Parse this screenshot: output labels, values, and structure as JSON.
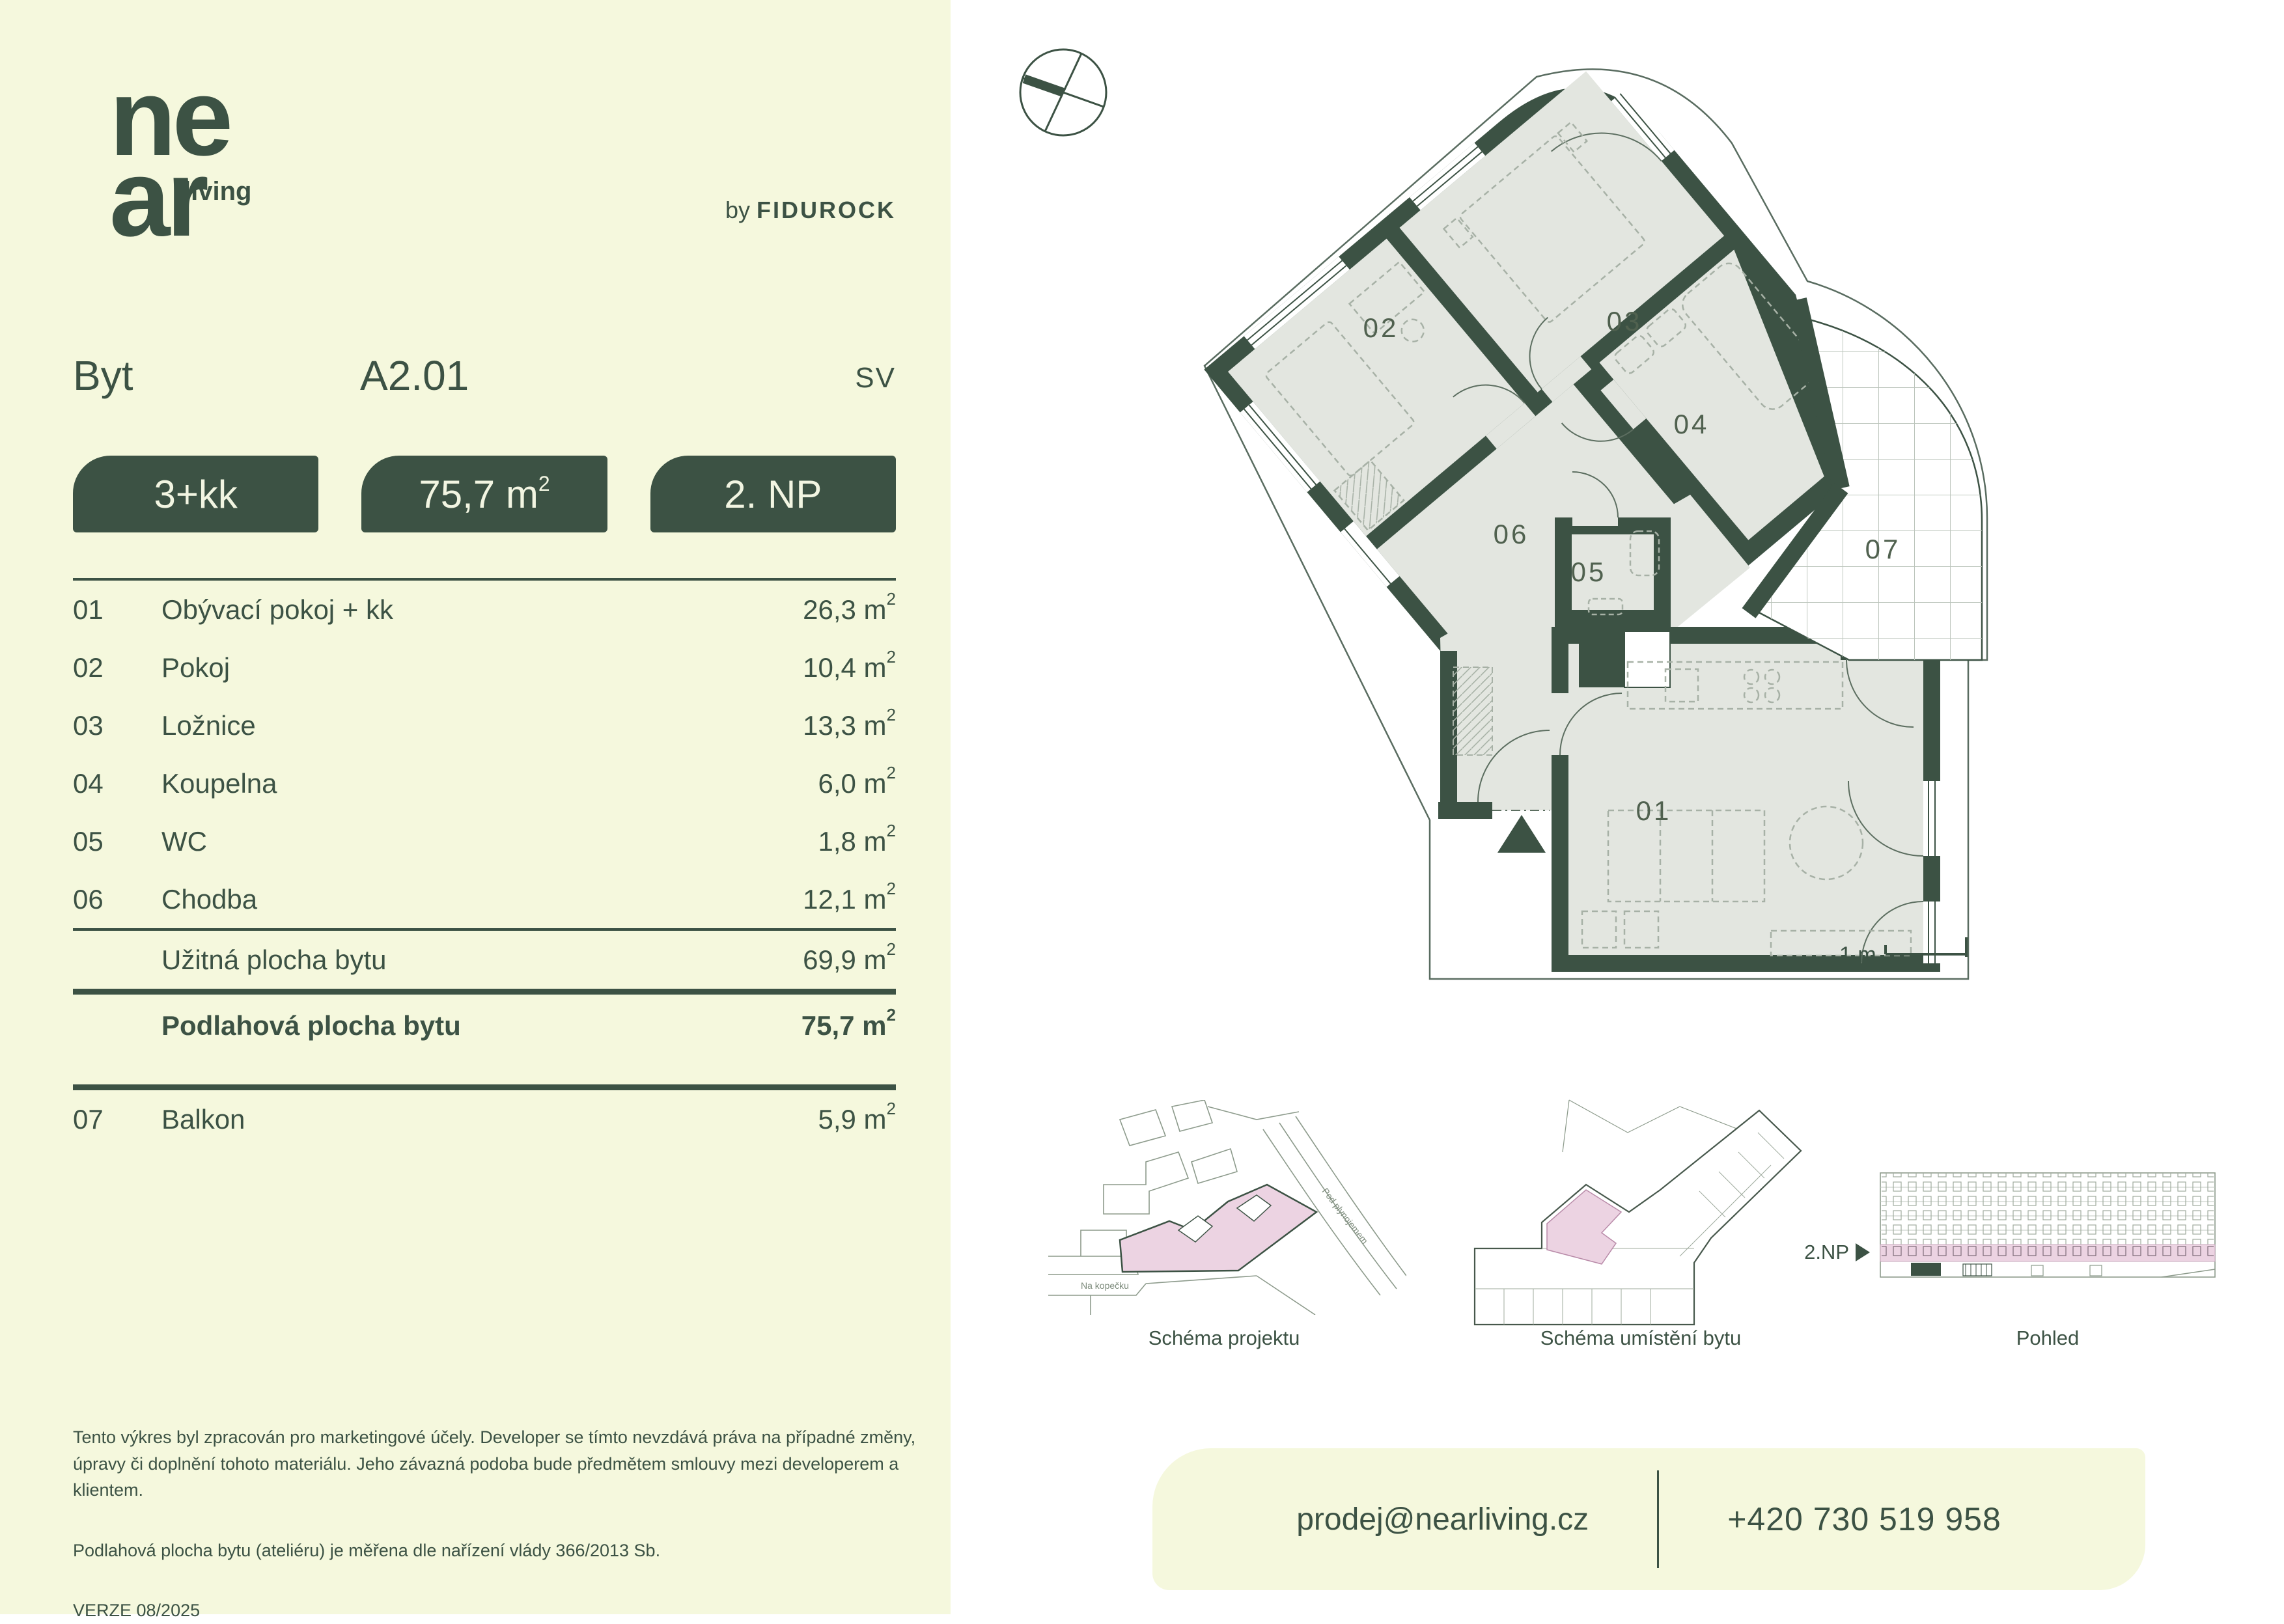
{
  "brand": {
    "logo_line1": "ne",
    "logo_line2": "ar",
    "logo_suffix": "living",
    "byline_prefix": "by",
    "byline_brand": "FIDUROCK"
  },
  "header": {
    "type_label": "Byt",
    "unit_id": "A2.01",
    "orientation": "SV"
  },
  "badges": {
    "disposition": "3+kk",
    "area_value": "75,7",
    "floor": "2. NP"
  },
  "units": {
    "m": "m",
    "sup": "2"
  },
  "rooms": [
    {
      "num": "01",
      "name": "Obývací pokoj + kk",
      "area": "26,3"
    },
    {
      "num": "02",
      "name": "Pokoj",
      "area": "10,4"
    },
    {
      "num": "03",
      "name": "Ložnice",
      "area": "13,3"
    },
    {
      "num": "04",
      "name": "Koupelna",
      "area": "6,0"
    },
    {
      "num": "05",
      "name": "WC",
      "area": "1,8"
    },
    {
      "num": "06",
      "name": "Chodba",
      "area": "12,1"
    }
  ],
  "summary": {
    "usable_label": "Užitná plocha bytu",
    "usable_area": "69,9",
    "floor_label": "Podlahová plocha bytu",
    "floor_area": "75,7"
  },
  "extra_room": {
    "num": "07",
    "name": "Balkon",
    "area": "5,9"
  },
  "disclaimer": {
    "p1": "Tento výkres byl zpracován pro marketingové účely. Developer se tímto nevzdává práva na případné změny, úpravy či doplnění tohoto materiálu. Jeho závazná podoba bude předmětem smlouvy mezi developerem a klientem.",
    "p2": "Podlahová plocha bytu (ateliéru) je měřena dle nařízení vlády 366/2013 Sb.",
    "version": "VERZE 08/2025"
  },
  "plan": {
    "labels": {
      "r01": "01",
      "r02": "02",
      "r03": "03",
      "r04": "04",
      "r05": "05",
      "r06": "06",
      "r07": "07"
    },
    "scale": "1 m"
  },
  "figures": {
    "project_caption": "Schéma projektu",
    "unit_caption": "Schéma umístění bytu",
    "view_caption": "Pohled",
    "floor_tag": "2.NP",
    "street1": "Na kopečku",
    "street2": "Pod plynojemem"
  },
  "contact": {
    "email": "prodej@nearliving.cz",
    "phone": "+420 730 519 958"
  },
  "colors": {
    "dark_green": "#3c5244",
    "panel_background": "#f5f8dd",
    "highlight_pink": "#ecd3e2",
    "floor_fill": "#e3e6e0",
    "page_background": "#ffffff"
  }
}
